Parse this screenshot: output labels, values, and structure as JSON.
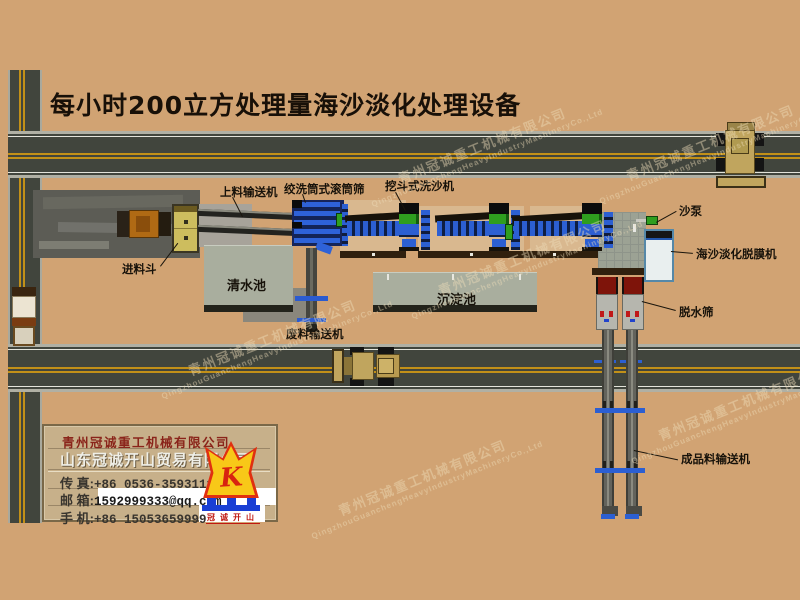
{
  "title": "每小时200立方处理量海沙淡化处理设备",
  "equipment_labels": {
    "feed_conveyor": "上料输送机",
    "drum_screen": "绞洗筒式滚筒筛",
    "bucket_washer": "挖斗式洗沙机",
    "feed_hopper": "进料斗",
    "clear_pool": "清水池",
    "sediment_pool": "沉淀池",
    "waste_conveyor": "废料输送机",
    "sand_pump": "沙泵",
    "desal_machine": "海沙淡化脱膜机",
    "dewater_screen": "脱水筛",
    "product_conveyor": "成品料输送机"
  },
  "company_card": {
    "line1": "青州冠诚重工机械有限公司",
    "line2": "山东冠诚开山贸易有限公司",
    "rows": [
      {
        "label": "传  真:",
        "value": "+86 0536-3593111"
      },
      {
        "label": "邮  箱:",
        "value": "1592999333@qq.com"
      },
      {
        "label": "手  机:",
        "value": "+86 15053659999"
      }
    ],
    "logo_letter": "K",
    "logo_text": "冠诚开山"
  },
  "watermark": {
    "cn": "青州冠诚重工机械有限公司",
    "en": "QingzhouGuanchengHeavyIndustryMachineryCo.,Ltd"
  },
  "colors": {
    "background": "#d1a373",
    "road_asphalt": "#41453d",
    "road_line_yellow": "#c29018",
    "pool_gray": "#a9ae9e",
    "machine_blue": "#2c5fd2",
    "machine_green": "#2f9e1f",
    "screen_red": "#7e140a",
    "logo_yellow": "#f8c818",
    "logo_red": "#e03010",
    "logo_blue": "#1a3fd4"
  }
}
